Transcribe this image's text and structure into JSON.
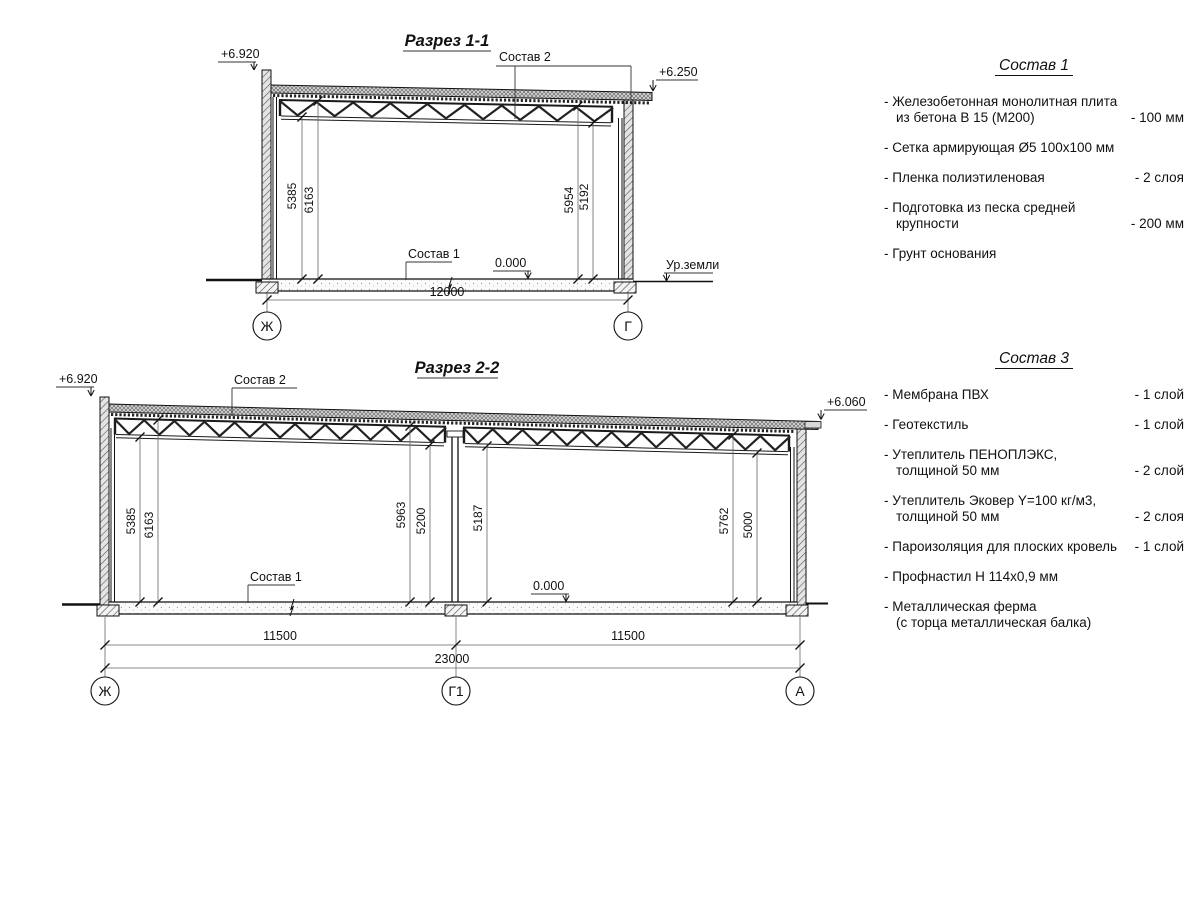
{
  "section1": {
    "title": "Разрез 1-1",
    "elev_left": "+6.920",
    "elev_right": "+6.250",
    "callout_roof": "Состав 2",
    "callout_floor": "Состав 1",
    "zero_mark": "0.000",
    "ground_label": "Ур.земли",
    "dim_left_lower": "5385",
    "dim_left_upper": "6163",
    "dim_right_upper": "5954",
    "dim_right_lower": "5192",
    "dim_span": "12000",
    "axis_left": "Ж",
    "axis_right": "Г"
  },
  "section2": {
    "title": "Разрез 2-2",
    "elev_left": "+6.920",
    "elev_right": "+6.060",
    "callout_roof": "Состав 2",
    "callout_floor": "Состав 1",
    "zero_mark": "0.000",
    "dim_l1": "5385",
    "dim_l2": "6163",
    "dim_m1": "5963",
    "dim_m2": "5200",
    "dim_m3": "5187",
    "dim_r1": "5762",
    "dim_r2": "5000",
    "dim_span_left": "11500",
    "dim_span_right": "11500",
    "dim_total": "23000",
    "axis_left": "Ж",
    "axis_mid": "Г1",
    "axis_right": "А"
  },
  "legend1": {
    "title": "Состав 1",
    "items": [
      {
        "line1": "- Железобетонная  монолитная плита",
        "line2": "из бетона В 15 (М200)",
        "value": "- 100 мм"
      },
      {
        "line1": "- Сетка армирующая Ø5 100х100 мм",
        "line2": "",
        "value": ""
      },
      {
        "line1": "- Пленка полиэтиленовая",
        "line2": "",
        "value": "-  2 слоя"
      },
      {
        "line1": "- Подготовка из песка средней",
        "line2": "крупности",
        "value": "- 200 мм"
      },
      {
        "line1": "- Грунт основания",
        "line2": "",
        "value": ""
      }
    ]
  },
  "legend3": {
    "title": "Состав 3",
    "items": [
      {
        "line1": "- Мембрана ПВХ",
        "line2": "",
        "value": "- 1 слой"
      },
      {
        "line1": "- Геотекстиль",
        "line2": "",
        "value": "- 1 слой"
      },
      {
        "line1": "- Утеплитель ПЕНОПЛЭКС,",
        "line2": "толщиной 50 мм",
        "value": "- 2 слой"
      },
      {
        "line1": "- Утеплитель Эковер Y=100 кг/м3,",
        "line2": "толщиной 50 мм",
        "value": "- 2 слоя"
      },
      {
        "line1": "- Пароизоляция для плоских кровель",
        "line2": "",
        "value": "- 1 слой"
      },
      {
        "line1": "- Профнастил Н 114х0,9 мм",
        "line2": "",
        "value": ""
      },
      {
        "line1": "- Металлическая ферма",
        "line2": "(с торца металлическая балка)",
        "value": ""
      }
    ]
  }
}
